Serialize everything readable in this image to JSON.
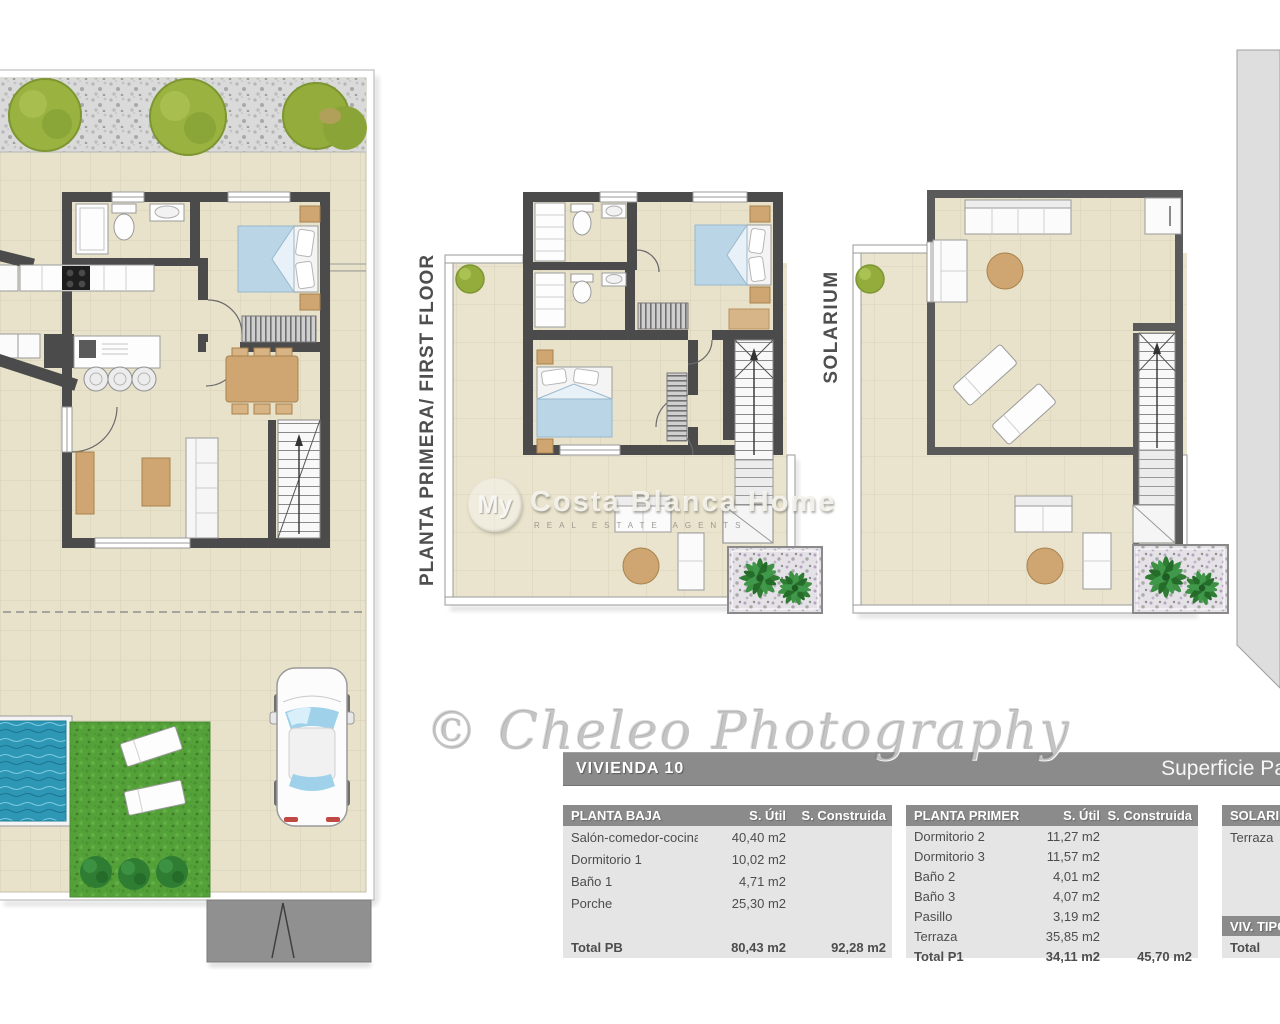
{
  "watermarks": {
    "photography": "© Cheleo Photography",
    "brand_prefix": "My",
    "brand_main": "Costa Blanca Home",
    "brand_sub": "REAL ESTATE AGENTS"
  },
  "plan_labels": {
    "first_floor": "PLANTA PRIMERA/ FIRST FLOOR",
    "solarium": "SOLARIUM"
  },
  "title_bar": {
    "title": "VIVIENDA 10",
    "right_text": "Superficie Pa"
  },
  "tables": [
    {
      "name": "PLANTA BAJA",
      "col_util": "S. Útil",
      "col_construida": "S. Construida",
      "rows": [
        {
          "label": "Salón-comedor-cocina",
          "util": "40,40 m2",
          "construida": ""
        },
        {
          "label": "Dormitorio 1",
          "util": "10,02 m2",
          "construida": ""
        },
        {
          "label": "Baño 1",
          "util": "4,71 m2",
          "construida": ""
        },
        {
          "label": "Porche",
          "util": "25,30 m2",
          "construida": ""
        }
      ],
      "total": {
        "label": "Total PB",
        "util": "80,43 m2",
        "construida": "92,28 m2"
      }
    },
    {
      "name": "PLANTA PRIMERA",
      "col_util": "S. Útil",
      "col_construida": "S. Construida",
      "rows": [
        {
          "label": "Dormitorio 2",
          "util": "11,27 m2",
          "construida": ""
        },
        {
          "label": "Dormitorio 3",
          "util": "11,57 m2",
          "construida": ""
        },
        {
          "label": "Baño 2",
          "util": "4,01 m2",
          "construida": ""
        },
        {
          "label": "Baño 3",
          "util": "4,07 m2",
          "construida": ""
        },
        {
          "label": "Pasillo",
          "util": "3,19 m2",
          "construida": ""
        },
        {
          "label": "Terraza",
          "util": "35,85 m2",
          "construida": ""
        }
      ],
      "total": {
        "label": "Total P1",
        "util": "34,11 m2",
        "construida": "45,70 m2"
      }
    },
    {
      "name": "SOLARIUM",
      "rows": [
        {
          "label": "Terraza",
          "util": "",
          "construida": ""
        }
      ],
      "sub_header": "VIV. TIPO",
      "total": {
        "label": "Total",
        "util": "",
        "construida": ""
      }
    }
  ],
  "colors": {
    "wall": "#4b4b4b",
    "tile": "#e8e2cb",
    "table_header": "#8b8b8b",
    "table_body": "#e5e5e5",
    "bed_blue": "#bad5e6",
    "wood_tan": "#cfa671",
    "lawn_green": "#55a139",
    "pool_blue": "#2d97b5",
    "neighbor_band": "#dedede"
  }
}
